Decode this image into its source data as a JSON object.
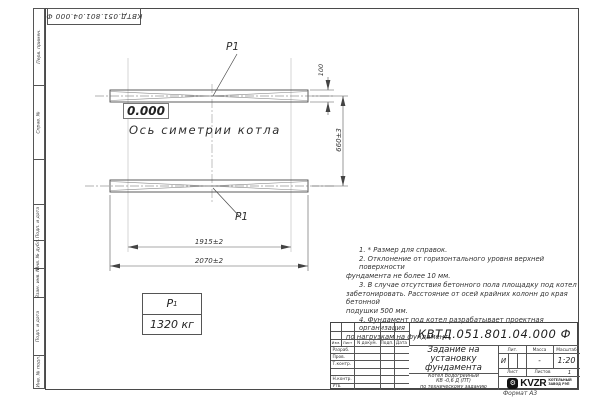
{
  "sheet": {
    "stamp_top": "КВТД.051.801.04.000  Ф",
    "format_label": "Формат А3"
  },
  "margin": {
    "labels": [
      "Перв. примен.",
      "Справ. №",
      "Подп. и дата",
      "Инв. № дубл.",
      "Взам. инв. №",
      "Подп. и дата",
      "Инв. № подл."
    ]
  },
  "drawing": {
    "p1_top_label": "Р1",
    "p1_bottom_label": "Р1",
    "zero_level": "0.000",
    "axis_label": "Ось симетрии котла",
    "dims": {
      "beam_width": "100",
      "beam_spacing": "660±3",
      "inner_span": "1915±2",
      "outer_span": "2070±2"
    }
  },
  "load_table": {
    "symbol": "Р",
    "symbol_sub": "1",
    "value": "1320 кг"
  },
  "notes": [
    "1. * Размер для справок.",
    "2. Отклонение от горизонтального уровня верхней поверхности",
    "фундамента не более 10 мм.",
    "3. В случае отсутствия бетонного пола площадку под котел",
    "забетонировать. Расстояние от осей крайних колонн до края бетонной",
    "подушки 500 мм.",
    "4. Фундамент под котел разрабатывает проектная организация",
    "по нагрузкам на фундамент."
  ],
  "title_block": {
    "doc_number": "КВТД.051.801.04.000  Ф",
    "title_lines": [
      "Задание на",
      "установку",
      "фундамента"
    ],
    "subtitle_lines": [
      "Котел Водогрейный",
      "КВ -0,6 Д  (ПТ)",
      "по техническому заданию"
    ],
    "header": {
      "izm": "Изм.",
      "list": "Лист",
      "doc": "N докум.",
      "sign": "Подп.",
      "date": "Дата"
    },
    "rows": [
      "Разраб.",
      "Пров.",
      "Т.контр.",
      "",
      "Н.контр.",
      "Утв."
    ],
    "lit_label": "Лит.",
    "mass_label": "Масса",
    "scale_label": "Масштаб",
    "lit_value": "И",
    "mass_value": "-",
    "scale_value": "1:20",
    "sheet_label": "Лист",
    "sheets_label": "Листов",
    "sheets_value": "1",
    "logo": {
      "text": "KVZR",
      "caption_lines": [
        "КОТЕЛЬНЫЙ",
        "ЗАВОД РЭП"
      ]
    }
  },
  "colors": {
    "line": "#4a4a4a",
    "text": "#222222",
    "logo": "#111111"
  }
}
